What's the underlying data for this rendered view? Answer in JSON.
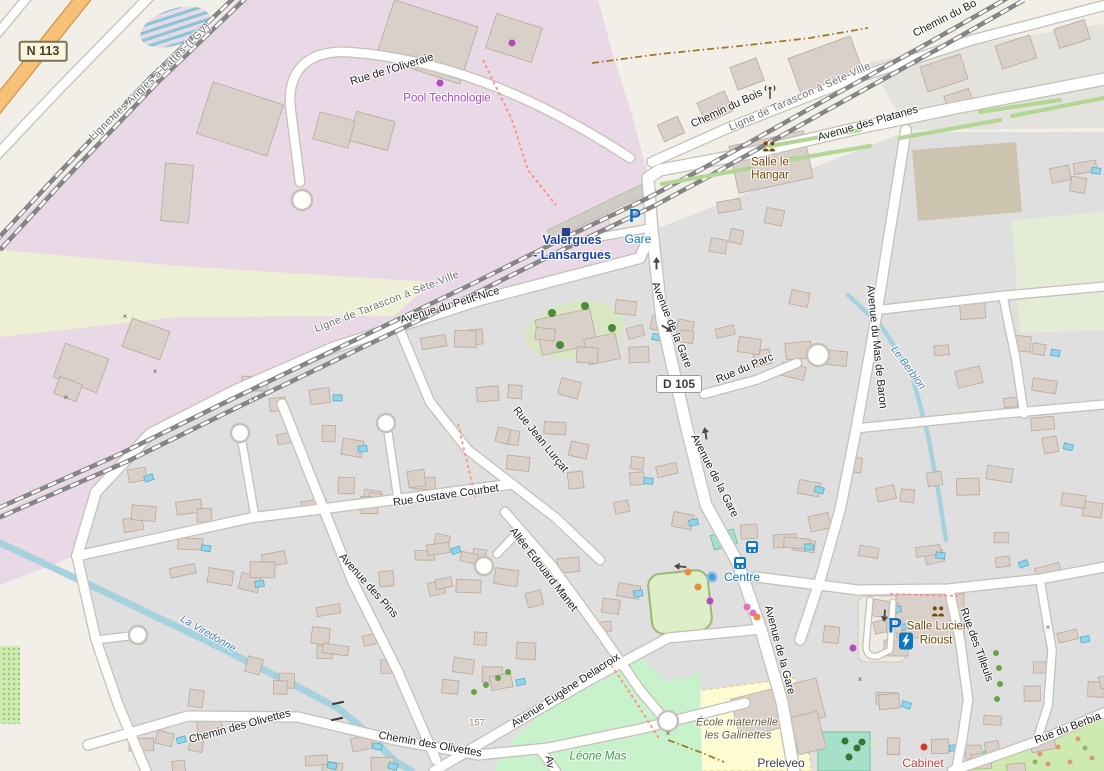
{
  "map": {
    "type": "openstreetmap-style street map",
    "locality": "Valergues - Lansargues"
  },
  "palette": {
    "industrial_area": "#e9d8e6",
    "residential_area": "#e0dfdf",
    "field": "#eef0d5",
    "park_green": "#c8f2cb",
    "school_yellow": "#fdfbd2",
    "pitch_teal": "#a8dfc8",
    "water_blue": "#a6d2de",
    "primary_road_orange": "#f6c178",
    "poi_blue": "#0b77c7",
    "station_blue": "#1d3f9e",
    "poi_brown": "#734a08",
    "poi_purple": "#a44bbf",
    "poi_red": "#c9403a",
    "poi_green": "#3f9747",
    "rail_gray": "#858585"
  },
  "badges": [
    {
      "text": "N 113",
      "x": 43,
      "y": 51,
      "kind": "n",
      "name": "road-badge-n113"
    },
    {
      "text": "D 105",
      "x": 679,
      "y": 384,
      "kind": "d",
      "name": "road-badge-d105"
    }
  ],
  "labels": [
    {
      "t": "Ligne des Angles à Lattes (LGV)",
      "x": 150,
      "y": 82,
      "r": -44,
      "k": "rail",
      "n": "railway-label"
    },
    {
      "t": "Rue de l'Oliveraie",
      "x": 392,
      "y": 70,
      "r": -17,
      "k": "road",
      "n": "road-label"
    },
    {
      "t": "Pool Technologie",
      "x": 447,
      "y": 99,
      "r": 0,
      "k": "poipurple",
      "n": "poi-label"
    },
    {
      "t": "Chemin du Bois",
      "x": 727,
      "y": 109,
      "r": -25,
      "k": "road",
      "n": "road-label"
    },
    {
      "t": "Chemin du Bo",
      "x": 945,
      "y": 19,
      "r": -27,
      "k": "road",
      "n": "road-label"
    },
    {
      "t": "Ligne de Tarascon à Sète-Ville",
      "x": 800,
      "y": 97,
      "r": -24,
      "k": "rail",
      "n": "railway-label"
    },
    {
      "t": "Avenue des Platanes",
      "x": 868,
      "y": 124,
      "r": -16,
      "k": "road",
      "n": "road-label"
    },
    {
      "t": "Salle le",
      "x": 770,
      "y": 163,
      "r": 0,
      "k": "poibrown",
      "n": "poi-label"
    },
    {
      "t": "Hangar",
      "x": 770,
      "y": 176,
      "r": 0,
      "k": "poibrown",
      "n": "poi-label"
    },
    {
      "t": "Valergues",
      "x": 572,
      "y": 240,
      "r": 0,
      "k": "station",
      "n": "station-label"
    },
    {
      "t": "- Lansargues",
      "x": 572,
      "y": 255,
      "r": 0,
      "k": "station",
      "n": "station-label"
    },
    {
      "t": "Gare",
      "x": 638,
      "y": 239,
      "r": 0,
      "k": "poiblue",
      "n": "poi-label"
    },
    {
      "t": "Ligne de Tarascon à Sète-Ville",
      "x": 387,
      "y": 302,
      "r": -21,
      "k": "rail",
      "n": "railway-label"
    },
    {
      "t": "Avenue du Petit-Nice",
      "x": 450,
      "y": 306,
      "r": -17,
      "k": "road",
      "n": "road-label"
    },
    {
      "t": "Avenue de la Gare",
      "x": 671,
      "y": 325,
      "r": 68,
      "k": "road",
      "n": "road-label"
    },
    {
      "t": "Rue du Parc",
      "x": 745,
      "y": 369,
      "r": -23,
      "k": "road",
      "n": "road-label"
    },
    {
      "t": "Avenue du Mas de Baron",
      "x": 876,
      "y": 347,
      "r": 84,
      "k": "road",
      "n": "road-label"
    },
    {
      "t": "Le Berbion",
      "x": 908,
      "y": 368,
      "r": 54,
      "k": "water",
      "n": "stream-label"
    },
    {
      "t": "Rue Jean Lurçat",
      "x": 540,
      "y": 440,
      "r": 51,
      "k": "road",
      "n": "road-label"
    },
    {
      "t": "Avenue de la Gare",
      "x": 714,
      "y": 476,
      "r": 63,
      "k": "road",
      "n": "road-label"
    },
    {
      "t": "Rue Gustave Courbet",
      "x": 446,
      "y": 496,
      "r": -8,
      "k": "road",
      "n": "road-label"
    },
    {
      "t": "Allée Edouard Manet",
      "x": 543,
      "y": 570,
      "r": 52,
      "k": "road",
      "n": "road-label"
    },
    {
      "t": "Avenue des Pins",
      "x": 368,
      "y": 586,
      "r": 48,
      "k": "road",
      "n": "road-label"
    },
    {
      "t": "Centre",
      "x": 742,
      "y": 577,
      "r": 0,
      "k": "poiblue",
      "n": "poi-label"
    },
    {
      "t": "La Viredonne",
      "x": 208,
      "y": 634,
      "r": 30,
      "k": "water",
      "n": "stream-label"
    },
    {
      "t": "Salle Lucien",
      "x": 938,
      "y": 627,
      "r": 0,
      "k": "poibrown",
      "n": "poi-label"
    },
    {
      "t": "Rioust",
      "x": 936,
      "y": 641,
      "r": 0,
      "k": "poibrown",
      "n": "poi-label"
    },
    {
      "t": "Avenue de la Gare",
      "x": 779,
      "y": 650,
      "r": 75,
      "k": "road",
      "n": "road-label"
    },
    {
      "t": "Rue des Tilleuls",
      "x": 976,
      "y": 645,
      "r": 70,
      "k": "road",
      "n": "road-label"
    },
    {
      "t": "Avenue Eugène Delacroix",
      "x": 566,
      "y": 691,
      "r": -33,
      "k": "road",
      "n": "road-label"
    },
    {
      "t": "Chemin des Olivettes",
      "x": 240,
      "y": 727,
      "r": -15,
      "k": "road",
      "n": "road-label"
    },
    {
      "t": "Chemin des Olivettes",
      "x": 430,
      "y": 745,
      "r": 10,
      "k": "road",
      "n": "road-label"
    },
    {
      "t": "157",
      "x": 477,
      "y": 723,
      "r": 0,
      "k": "housenum",
      "n": "house-number"
    },
    {
      "t": "École maternelle",
      "x": 737,
      "y": 723,
      "r": 0,
      "k": "school",
      "n": "poi-label"
    },
    {
      "t": "les Galinettes",
      "x": 738,
      "y": 736,
      "r": 0,
      "k": "school",
      "n": "poi-label"
    },
    {
      "t": "Léone Mas",
      "x": 598,
      "y": 757,
      "r": 0,
      "k": "poigreen",
      "n": "poi-label"
    },
    {
      "t": "Preleveo",
      "x": 781,
      "y": 763,
      "r": 0,
      "k": "poidark",
      "n": "poi-label"
    },
    {
      "t": "Cabinet",
      "x": 923,
      "y": 763,
      "r": 0,
      "k": "poired",
      "n": "poi-label"
    },
    {
      "t": "Rue du Berbia",
      "x": 1068,
      "y": 729,
      "r": -21,
      "k": "road",
      "n": "road-label"
    },
    {
      "t": "Av",
      "x": 549,
      "y": 762,
      "r": 80,
      "k": "road",
      "n": "road-label"
    }
  ],
  "icons": [
    {
      "name": "parking-icon",
      "glyph": "P",
      "x": 635,
      "y": 216,
      "size": 18
    },
    {
      "name": "parking-icon",
      "glyph": "P",
      "x": 895,
      "y": 626,
      "size": 21
    },
    {
      "name": "bus-stop-icon",
      "x": 752,
      "y": 547
    },
    {
      "name": "bus-stop-icon",
      "x": 740,
      "y": 563
    },
    {
      "name": "railway-station-icon",
      "x": 566,
      "y": 232
    },
    {
      "name": "antenna-icon",
      "x": 770,
      "y": 95
    },
    {
      "name": "community-centre-icon",
      "x": 769,
      "y": 148
    },
    {
      "name": "community-centre-icon",
      "x": 938,
      "y": 613
    },
    {
      "name": "ev-charging-icon",
      "x": 906,
      "y": 641
    },
    {
      "name": "fountain-icon",
      "x": 712,
      "y": 577
    }
  ],
  "oneway_arrows": [
    {
      "x": 657,
      "y": 263,
      "r": -90
    },
    {
      "x": 667,
      "y": 329,
      "r": 30
    },
    {
      "x": 706,
      "y": 433,
      "r": -100
    },
    {
      "x": 680,
      "y": 566,
      "r": 185
    },
    {
      "x": 884,
      "y": 616,
      "r": 95
    }
  ],
  "gate_markers": [
    [
      125,
      317
    ],
    [
      155,
      372
    ],
    [
      66,
      398
    ],
    [
      253,
      400
    ],
    [
      860,
      680
    ],
    [
      1048,
      628
    ],
    [
      668,
      734
    ]
  ],
  "bridge_ticks": [
    [
      338,
      703
    ],
    [
      337,
      719
    ]
  ],
  "row_trees": [
    [
      474,
      692
    ],
    [
      486,
      685
    ],
    [
      498,
      678
    ],
    [
      508,
      672
    ],
    [
      996,
      653
    ],
    [
      999,
      668
    ],
    [
      1000,
      684
    ],
    [
      997,
      699
    ]
  ],
  "garden_trees": [
    [
      552,
      313
    ],
    [
      585,
      306
    ],
    [
      612,
      328
    ],
    [
      560,
      345
    ]
  ],
  "pitch_trees": [
    [
      845,
      741
    ],
    [
      857,
      748
    ],
    [
      849,
      757
    ],
    [
      862,
      742
    ]
  ],
  "poi_dots": [
    {
      "c": "purple",
      "x": 440,
      "y": 83
    },
    {
      "c": "purple",
      "x": 512,
      "y": 43
    },
    {
      "c": "purple",
      "x": 710,
      "y": 601
    },
    {
      "c": "purple",
      "x": 853,
      "y": 648
    },
    {
      "c": "orange",
      "x": 688,
      "y": 572
    },
    {
      "c": "orange",
      "x": 698,
      "y": 587
    },
    {
      "c": "orange",
      "x": 757,
      "y": 617
    },
    {
      "c": "pink",
      "x": 747,
      "y": 607
    },
    {
      "c": "pink",
      "x": 753,
      "y": 613
    },
    {
      "c": "red",
      "x": 924,
      "y": 747
    }
  ],
  "dot_colors": {
    "purple": "#b44bbd",
    "orange": "#e8913a",
    "pink": "#e670b5",
    "red": "#d23b33"
  }
}
